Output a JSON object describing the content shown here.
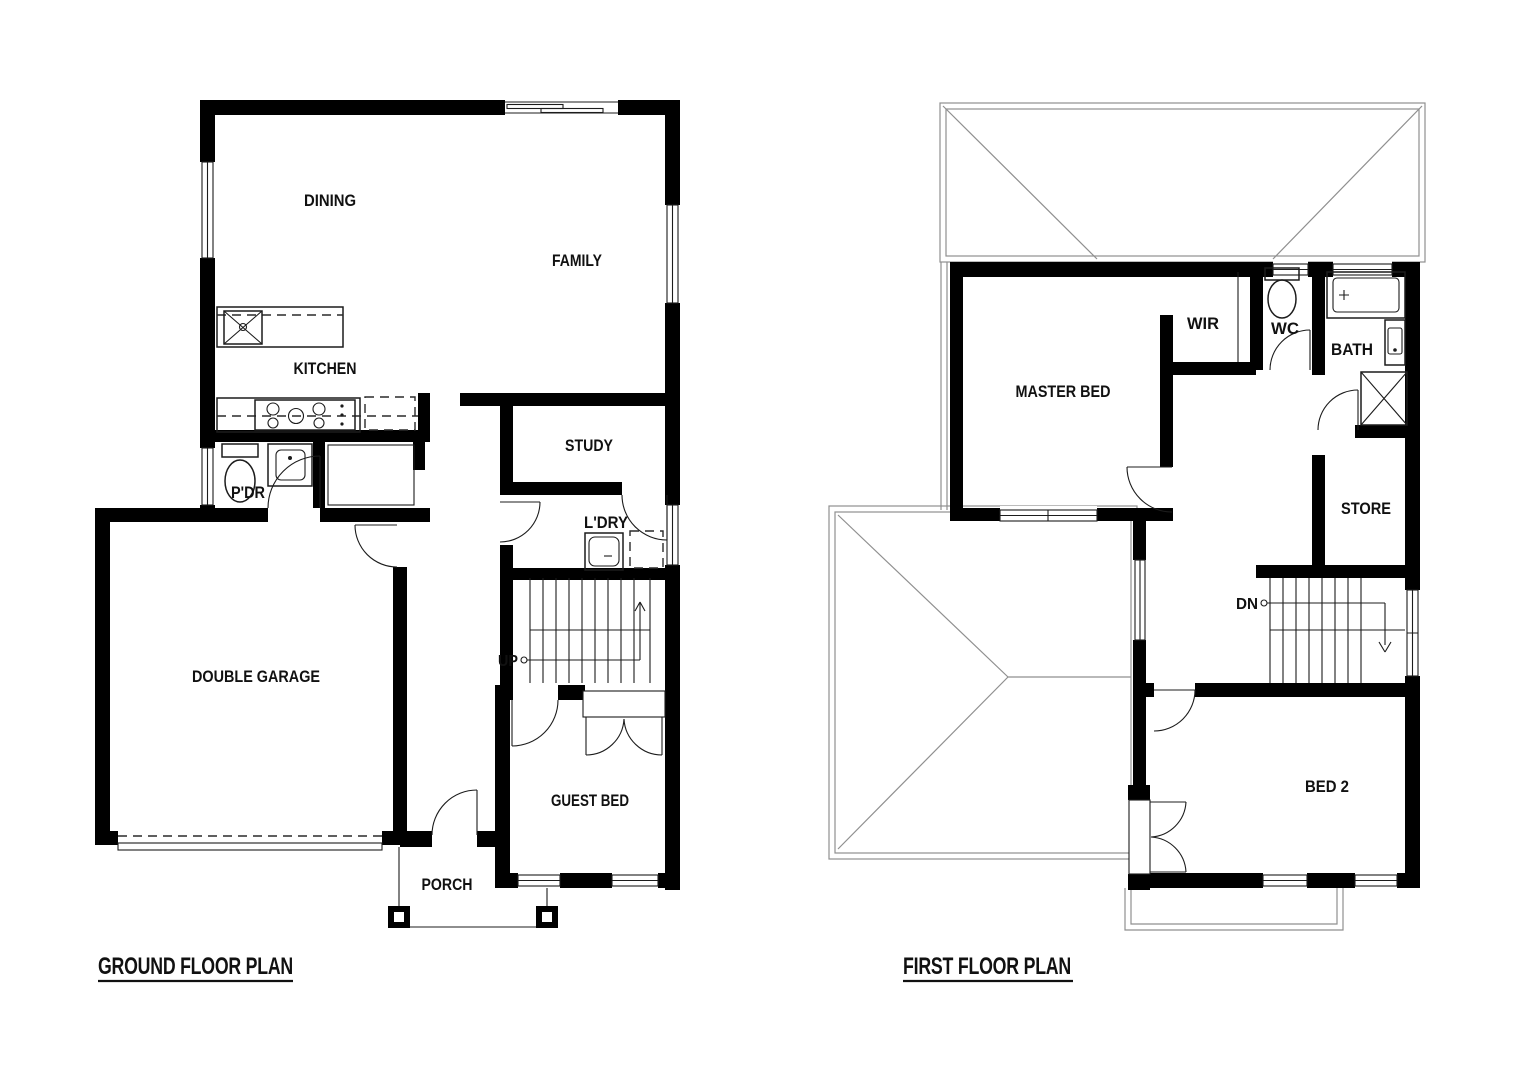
{
  "document": {
    "background": "#ffffff"
  },
  "colors": {
    "wall": "#000000",
    "line": "#1c1c1c",
    "roof_line": "#8f8f8f",
    "text": "#111111"
  },
  "ground_floor": {
    "title": "GROUND FLOOR PLAN",
    "stair_label": "UP",
    "rooms": {
      "dining": "DINING",
      "family": "FAMILY",
      "kitchen": "KITCHEN",
      "study": "STUDY",
      "pdr": "P'DR",
      "ldry": "L'DRY",
      "garage": "DOUBLE GARAGE",
      "guest_bed": "GUEST BED",
      "porch": "PORCH"
    }
  },
  "first_floor": {
    "title": "FIRST FLOOR PLAN",
    "stair_label": "DN",
    "rooms": {
      "master_bed": "MASTER BED",
      "wir": "WIR",
      "wc": "WC",
      "bath": "BATH",
      "store": "STORE",
      "bed2": "BED 2"
    }
  }
}
